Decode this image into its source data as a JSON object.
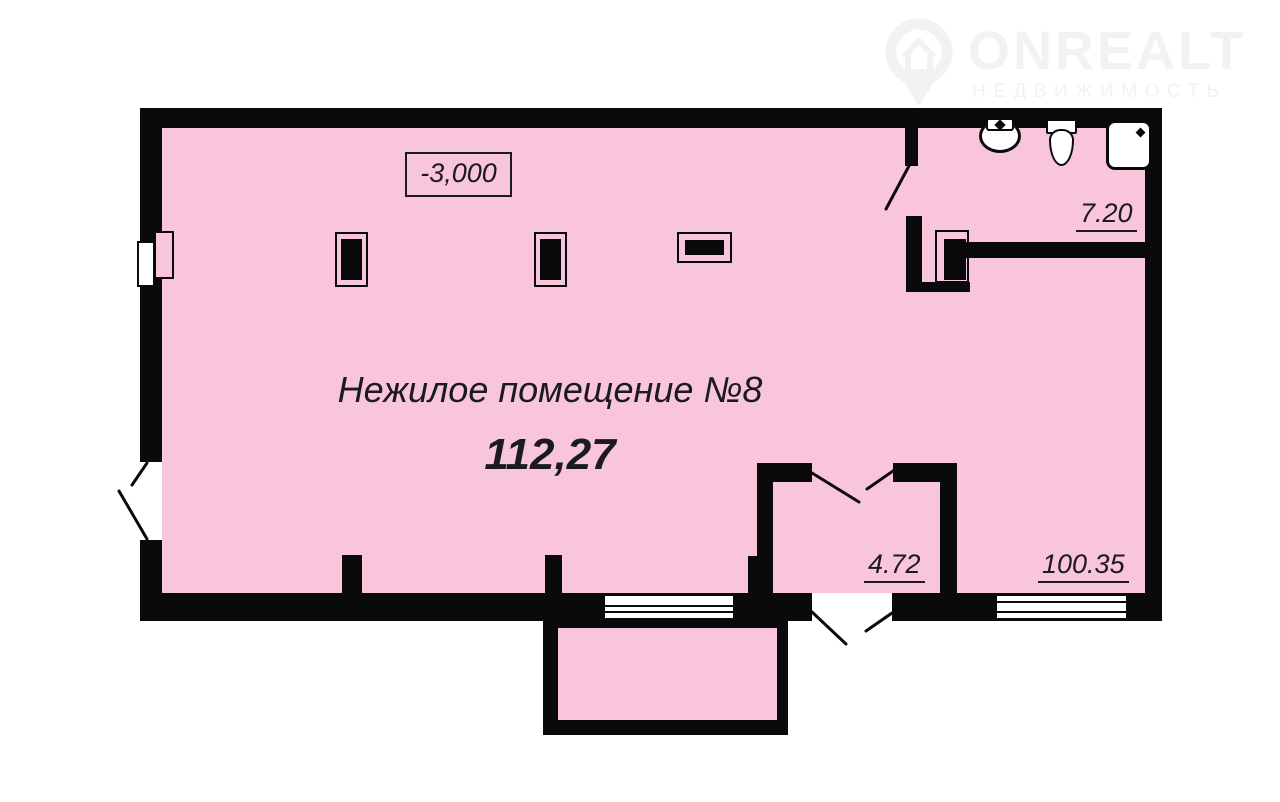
{
  "logo": {
    "brand": "ONREALT",
    "subtitle": "НЕДВИЖИМОСТЬ"
  },
  "plan": {
    "elevation_label": "-3,000",
    "unit_title": "Нежилое помещение №8",
    "unit_area": "112,27",
    "room_areas": {
      "sanitary": "7.20",
      "hall": "4.72",
      "main": "100.35"
    }
  },
  "icons": {
    "logo_pin": "map-pin-house-icon",
    "sink": "sink-icon",
    "toilet": "toilet-icon",
    "shower": "shower-tray-icon"
  },
  "colors": {
    "room-pink": "#f9c5dd",
    "wall-black": "#0a0a0a",
    "line-dark": "#1b1b1b",
    "logo-gray": "#f2f2f2"
  }
}
